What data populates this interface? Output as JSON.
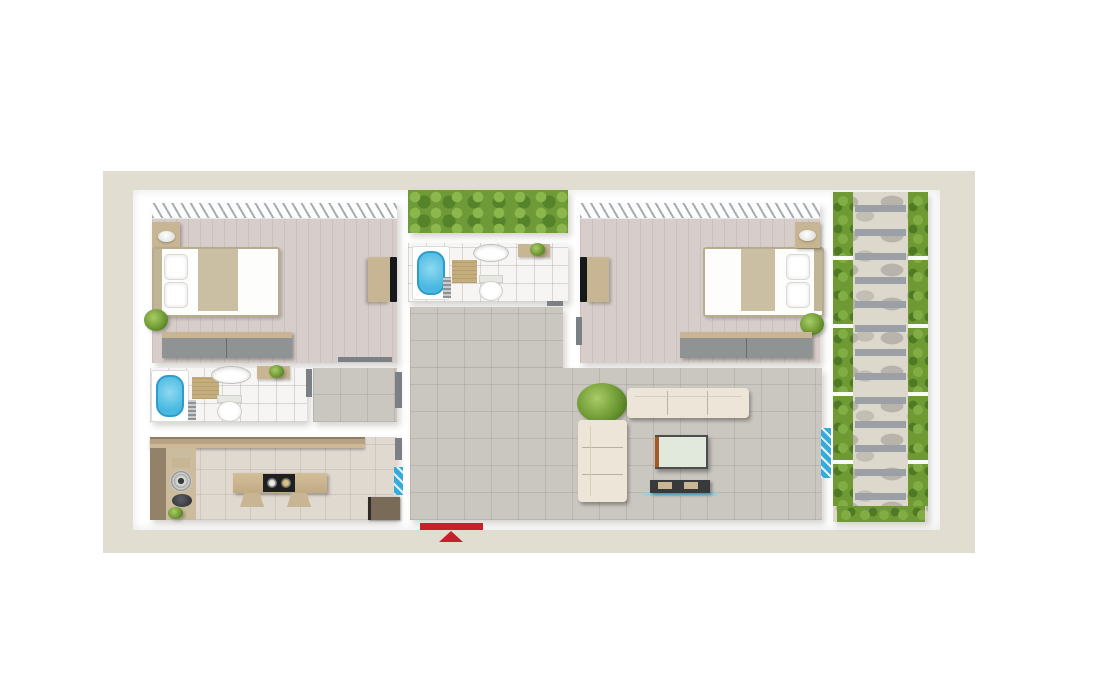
{
  "canvas": {
    "width": 1096,
    "height": 693
  },
  "palette": {
    "beige": "#e2ddd1",
    "wall": "#ffffff",
    "wood": "#d7cdca",
    "tileHall": "#cac6c0",
    "tileBath": "#f6f5f3",
    "tileKitchen": "#e0d9d0",
    "hedge": "#6f9a38",
    "bush": "#6f9a33",
    "stoneBg": "#ddd8cc",
    "stone": "#b8b4ab",
    "slat": "#9aa0a6",
    "tub": "#49b9e2",
    "glassBlue": "#38a9db",
    "tan": "#c7b593",
    "mat": "#c4ae7e",
    "wardrobeGray": "#909394",
    "sofa": "#ece5d8",
    "cooktop": "#1e1f21",
    "tv": "#17181a",
    "door": "#7b8084",
    "red": "#c5202b",
    "tableGlass": "#e0e9dc",
    "accentOrange": "#a85a26"
  },
  "floorplan": {
    "type": "apartment-top-view",
    "rooms": [
      {
        "id": "bedroom-1",
        "furniture": [
          "nightstand-lamp",
          "double-bed",
          "potted-plant",
          "wardrobe",
          "tv-cabinet",
          "window-curtain"
        ]
      },
      {
        "id": "patio-hedge",
        "furniture": [
          "hedge-plants"
        ]
      },
      {
        "id": "bathroom-1",
        "furniture": [
          "bathtub",
          "bath-mat",
          "towel-rail",
          "washbasin",
          "toilet",
          "shelf-with-plant"
        ]
      },
      {
        "id": "bedroom-2",
        "furniture": [
          "tv-cabinet",
          "double-bed",
          "nightstand-lamp",
          "potted-plant",
          "wardrobe",
          "window-curtain"
        ]
      },
      {
        "id": "side-garden",
        "furniture": [
          "stone-path",
          "stepping-slats",
          "bushes"
        ]
      },
      {
        "id": "hallway",
        "furniture": []
      },
      {
        "id": "living-room",
        "furniture": [
          "potted-plant",
          "three-seat-sofa",
          "two-seat-sofa",
          "dining-table",
          "tv-stand"
        ]
      },
      {
        "id": "bathroom-2",
        "furniture": [
          "bathtub",
          "bath-mat",
          "towel-rail",
          "washbasin",
          "toilet",
          "shelf-with-plant"
        ]
      },
      {
        "id": "kitchen",
        "furniture": [
          "counter",
          "hob-burner",
          "kitchen-sink",
          "cutting-board",
          "island-with-cooktop",
          "two-chairs",
          "cabinet",
          "potted-plant"
        ]
      }
    ],
    "doors": [
      "bedroom-1-door",
      "bedroom-2-door",
      "bathroom-1-door",
      "bathroom-2-door",
      "hall-door",
      "kitchen-door"
    ],
    "windows": [
      "entry-glass-panel",
      "garden-glass-door"
    ],
    "garden": {
      "stepping_slats": 13,
      "bush_columns": 2
    },
    "entrance": {
      "marker": "red-bar-with-arrow",
      "direction": "up",
      "color": "#c5202b"
    }
  }
}
